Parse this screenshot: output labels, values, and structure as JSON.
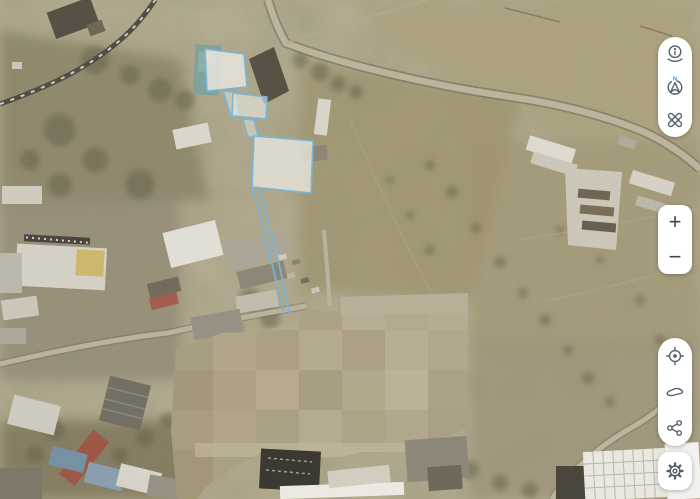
{
  "view": {
    "type": "satellite-map",
    "description": "aerial imagery with selected land parcels outlined in blue and a large pixelated censored area"
  },
  "map": {
    "selection_outline_color": "#79b6d9",
    "selected_parcels_count": 3,
    "censored_area_present": true,
    "terrain_base_color": "#a39a77"
  },
  "controls": {
    "compass_badge": "N",
    "zoom_in_label": "+",
    "zoom_out_label": "−",
    "panel_background": "#ffffff",
    "icon_color": "#54606c",
    "north_badge_color": "#2f80ed",
    "buttons": [
      {
        "id": "info",
        "icon": "info-icon"
      },
      {
        "id": "compass",
        "icon": "compass-north-icon"
      },
      {
        "id": "measure",
        "icon": "measure-icon"
      },
      {
        "id": "zoom-in",
        "icon": "plus-label"
      },
      {
        "id": "zoom-out",
        "icon": "minus-label"
      },
      {
        "id": "locate",
        "icon": "locate-icon"
      },
      {
        "id": "region",
        "icon": "region-shape-icon"
      },
      {
        "id": "share",
        "icon": "share-icon"
      },
      {
        "id": "settings",
        "icon": "gear-icon"
      }
    ]
  }
}
